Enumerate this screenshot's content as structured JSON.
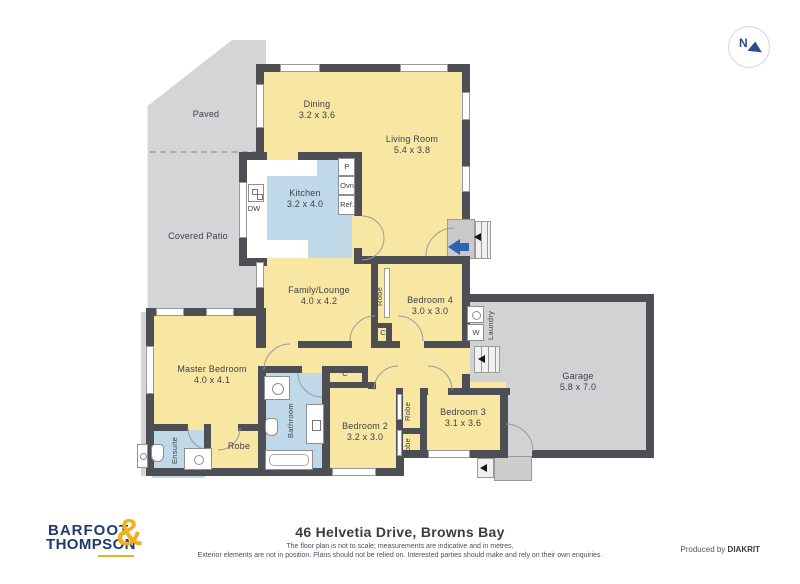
{
  "compass": {
    "n": "N"
  },
  "areas": {
    "paved": "Paved",
    "covered_patio": "Covered Patio"
  },
  "rooms": {
    "dining": {
      "name": "Dining",
      "dims": "3.2 x 3.6"
    },
    "living": {
      "name": "Living Room",
      "dims": "5.4 x 3.8"
    },
    "kitchen": {
      "name": "Kitchen",
      "dims": "3.2 x 4.0"
    },
    "family": {
      "name": "Family/Lounge",
      "dims": "4.0 x 4.2"
    },
    "bedroom4": {
      "name": "Bedroom 4",
      "dims": "3.0 x 3.0"
    },
    "master": {
      "name": "Master Bedroom",
      "dims": "4.0 x 4.1"
    },
    "bedroom2": {
      "name": "Bedroom 2",
      "dims": "3.2 x 3.0"
    },
    "bedroom3": {
      "name": "Bedroom 3",
      "dims": "3.1 x 3.6"
    },
    "garage": {
      "name": "Garage",
      "dims": "5.8 x 7.0"
    },
    "bathroom": {
      "name": "Bathroom"
    },
    "ensuite": {
      "name": "Ensuite"
    },
    "laundry": {
      "name": "Laundry"
    },
    "robe": {
      "name": "Robe"
    }
  },
  "fixtures": {
    "pantry": "P",
    "oven": "Ovn",
    "fridge": "Ref.",
    "dishwasher": "DW",
    "washer": "W",
    "cupboard": "C"
  },
  "footer": {
    "brand_top": "BARFOOT",
    "brand_bottom": "THOMPSON",
    "ampersand": "&",
    "address": "46 Helvetia Drive, Browns Bay",
    "disclaimer_line1": "The floor plan is not to scale; measurements are indicative and in metres.",
    "disclaimer_line2": "Exterior elements are not in position. Plans should not be relied on. Interested parties should make and rely on their own enquiries.",
    "produced_by": "Produced by",
    "producer": "DIAKRIT"
  },
  "colors": {
    "room_fill": "#f7e7a3",
    "wet_fill": "#bfd9e9",
    "outdoor_fill": "#d5d5d7",
    "wall": "#4e4e55",
    "accent_blue": "#2e63ae",
    "brand_navy": "#1e3a6e",
    "brand_gold": "#f2af1d"
  }
}
